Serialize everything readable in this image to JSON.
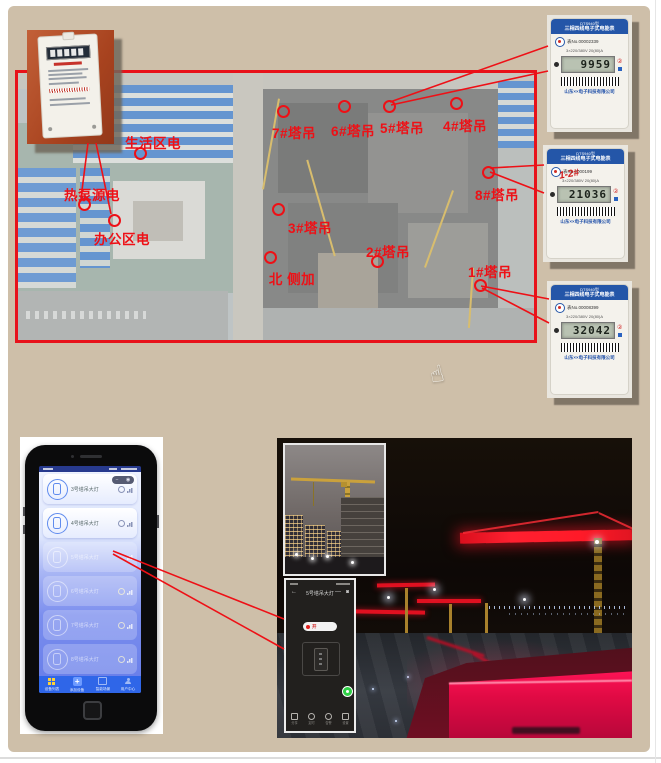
{
  "page": {
    "panel_bg": "#cebfa9",
    "annotation_red": "#ee1016"
  },
  "map": {
    "power_points": [
      {
        "label": "生活区电"
      },
      {
        "label": "热泵源电"
      },
      {
        "label": "办公区电"
      }
    ],
    "cranes": [
      {
        "label": "7#塔吊"
      },
      {
        "label": "6#塔吊"
      },
      {
        "label": "5#塔吊"
      },
      {
        "label": "4#塔吊"
      },
      {
        "label": "8#塔吊"
      },
      {
        "label": "3#塔吊"
      },
      {
        "label": "2#塔吊"
      },
      {
        "label": "1#塔吊"
      }
    ],
    "note": {
      "label": "北 侧加"
    }
  },
  "meters": {
    "model": "DTS940型",
    "type_name": "三相四线电子式电能表",
    "spec": "3×220/380V 20(80)A",
    "company": "山东××电子科技有限公司",
    "items": [
      {
        "serial": "表No.00002339",
        "reading": "9959",
        "tag": ""
      },
      {
        "serial": "表No.0000199",
        "reading": "21036",
        "tag": "1-2#"
      },
      {
        "serial": "表No.00008399",
        "reading": "32042",
        "tag": ""
      }
    ]
  },
  "app": {
    "cards": [
      {
        "label": "3号塔吊大灯"
      },
      {
        "label": "4号塔吊大灯"
      },
      {
        "label": "5号塔吊大灯"
      },
      {
        "label": "6号塔吊大灯"
      },
      {
        "label": "7号塔吊大灯"
      },
      {
        "label": "8号塔吊大灯"
      }
    ],
    "nav": [
      {
        "label": "设备列表"
      },
      {
        "label": "添加设备"
      },
      {
        "label": "智能场景"
      },
      {
        "label": "用户中心"
      }
    ],
    "toggle": {
      "minus": "−",
      "dot": "◉"
    }
  },
  "control": {
    "title": "5号塔吊大灯",
    "back": "←",
    "minimize": "—",
    "window": "◙",
    "power_label": "开",
    "actions": [
      {
        "label": "分享"
      },
      {
        "label": "定时"
      },
      {
        "label": "告警"
      },
      {
        "label": "设置"
      }
    ]
  },
  "misc": {
    "circled_two": "②",
    "plus": "+",
    "hand": "☝"
  }
}
